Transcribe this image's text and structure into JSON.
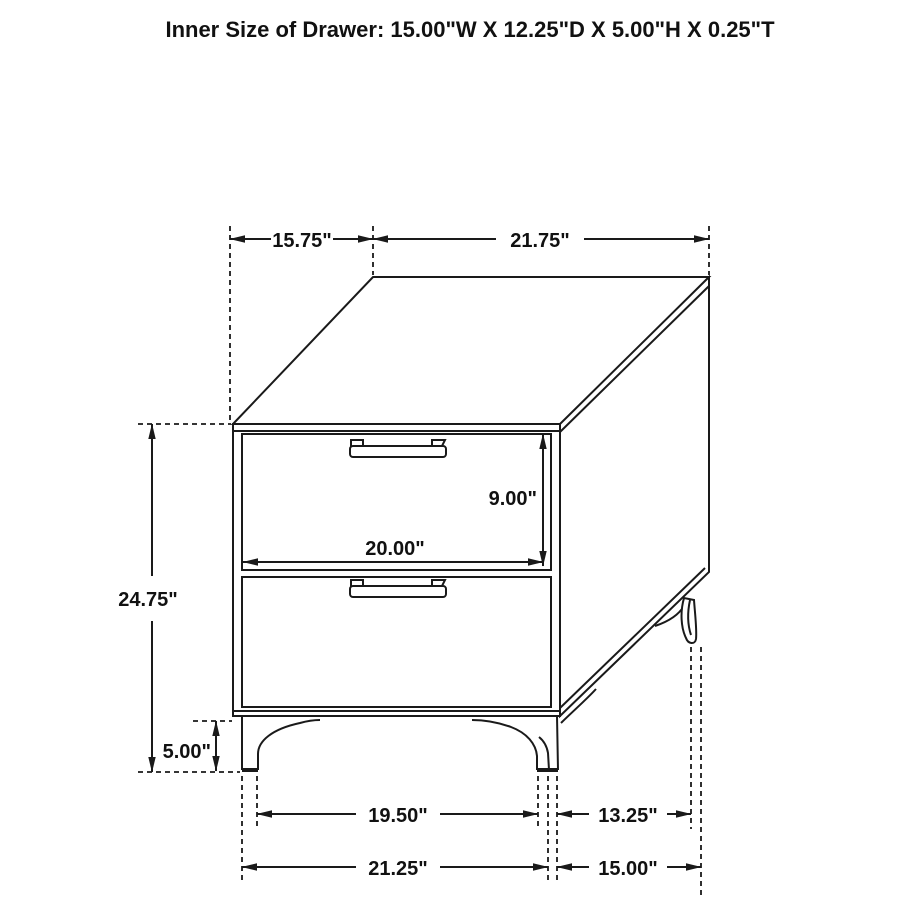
{
  "title": "Inner Size of Drawer: 15.00\"W X 12.25\"D X 5.00\"H X 0.25\"T",
  "colors": {
    "line": "#1a1a1a",
    "background": "#ffffff",
    "text": "#111111"
  },
  "dimensions": {
    "top_depth": "15.75\"",
    "top_width": "21.75\"",
    "overall_height": "24.75\"",
    "leg_height": "5.00\"",
    "drawer_opening_height": "9.00\"",
    "drawer_opening_width": "20.00\"",
    "front_leg_inner_span": "19.50\"",
    "side_leg_span": "13.25\"",
    "front_overall_width": "21.25\"",
    "side_overall_depth": "15.00\""
  }
}
